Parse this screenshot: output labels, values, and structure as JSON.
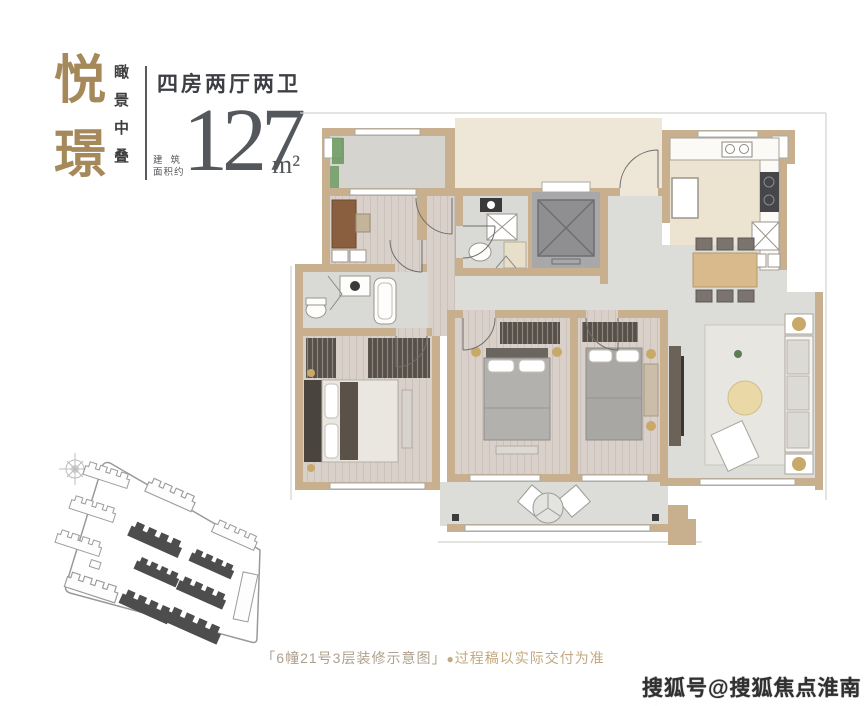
{
  "brand": {
    "title_char_1": "悦",
    "title_char_2": "璟",
    "tagline": "瞰景中叠"
  },
  "unit_info": {
    "layout_type": "四房两厅两卫",
    "area_label_line1": "建筑",
    "area_label_line2": "面积约",
    "area_value": "127",
    "area_unit": "m²"
  },
  "caption": {
    "plan_label": "「6幢21号3层装修示意图」",
    "bullet": "●",
    "disclaimer": "过程稿以实际交付为准"
  },
  "watermark": {
    "text": "搜狐号@搜狐焦点淮南站"
  },
  "colors": {
    "brand_gold": "#a6895a",
    "heading_text": "#3c3f44",
    "area_number": "#54575b",
    "caption_plan_label": "#aea08f",
    "caption_disclaimer": "#c3a97f",
    "wall_tan": "#c8b08f",
    "floor_beige": "#eee6d6",
    "floor_wood": "#d9d0ca",
    "floor_tile": "#dcdcd8",
    "bath_tile": "#d9d9d5",
    "elevator_gray": "#8f8f91",
    "plant_green": "#6e9a64",
    "accent_gold": "#c9a96a",
    "pouf_yellow": "#ead9a6",
    "site_building_dark": "#4d4d4d",
    "site_outline": "#9a9a9a",
    "watermark_text": "#303030"
  }
}
